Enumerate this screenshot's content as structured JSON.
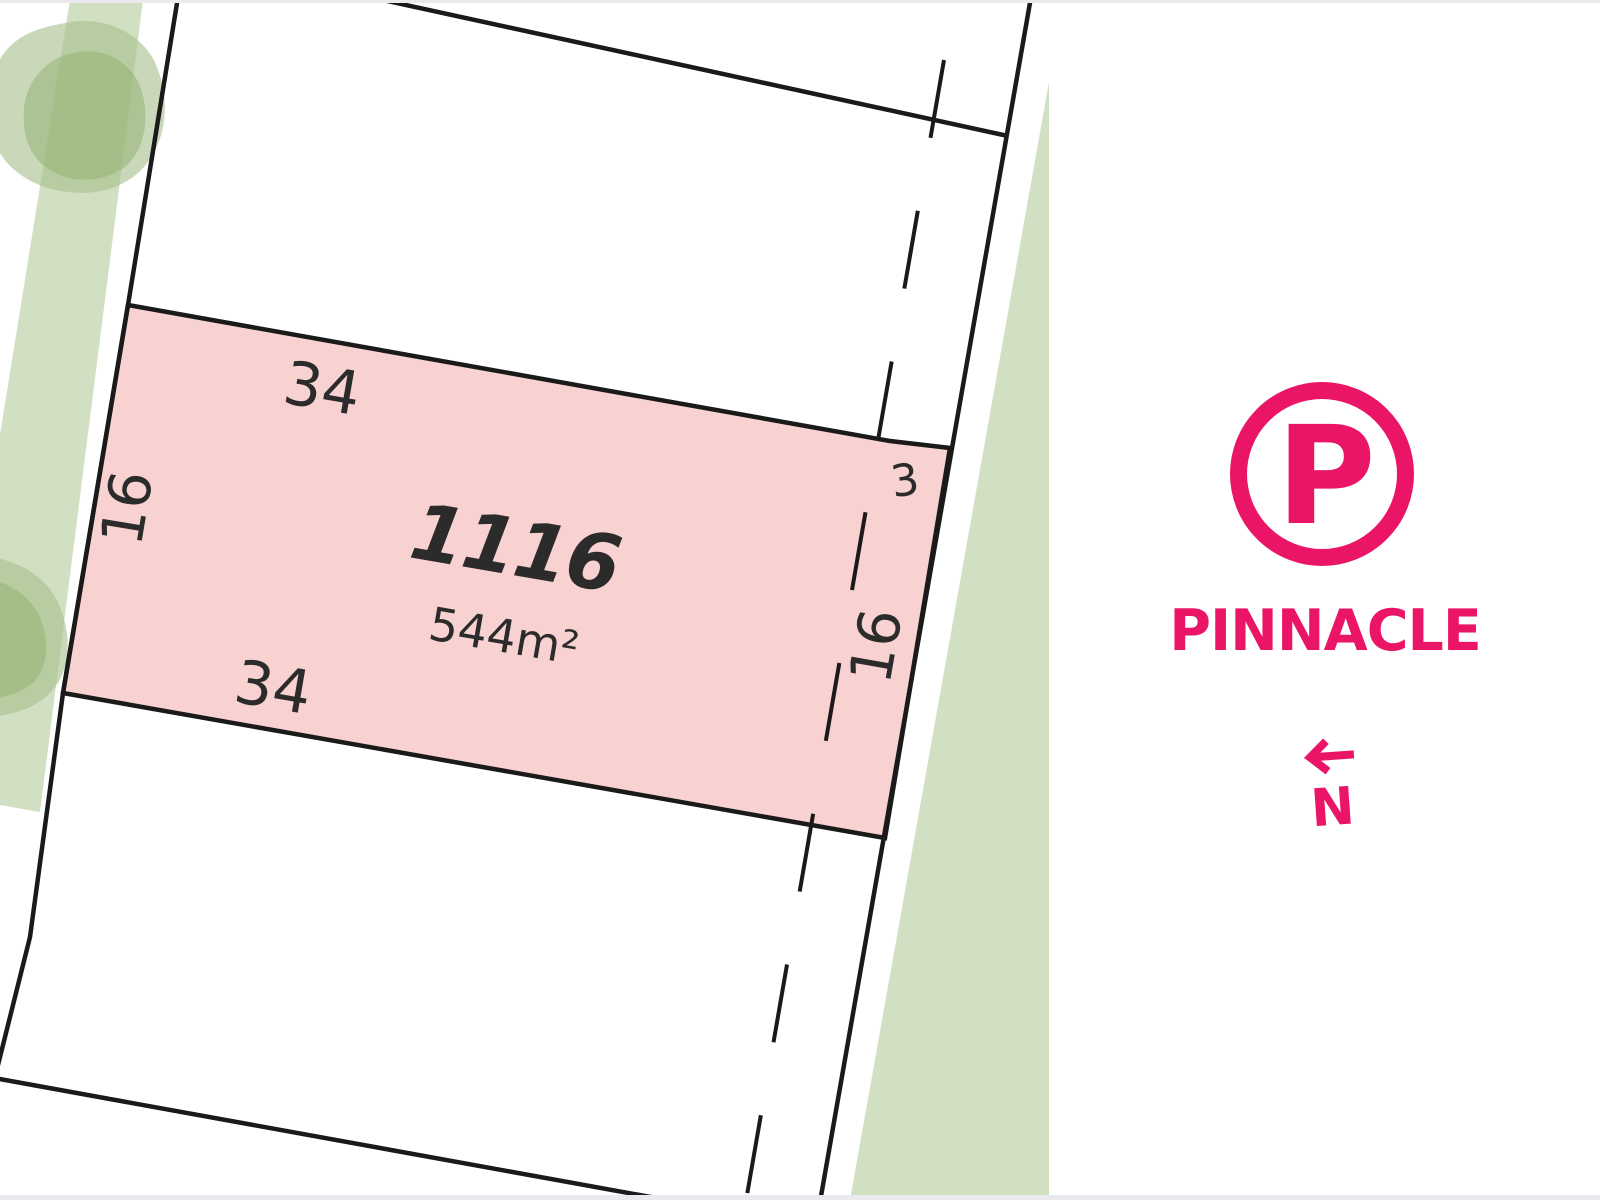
{
  "brand": {
    "name": "PINNACLE",
    "logo_letter": "P",
    "north_label": "N",
    "color": "#EA1566"
  },
  "lot": {
    "number": "1116",
    "area": "544m²",
    "dimensions": {
      "top_width": "34",
      "bottom_width": "34",
      "left_depth": "16",
      "right_depth": "16",
      "corner": "3"
    }
  },
  "map": {
    "colors": {
      "lot_fill": "#F8D1D1",
      "reserve_green": "#D1DFC3",
      "tree_green": "#A8C08C",
      "boundary_black": "#1A1A1A",
      "label_color": "#2B2B2B",
      "edge_gray": "#EAEAEE"
    }
  }
}
